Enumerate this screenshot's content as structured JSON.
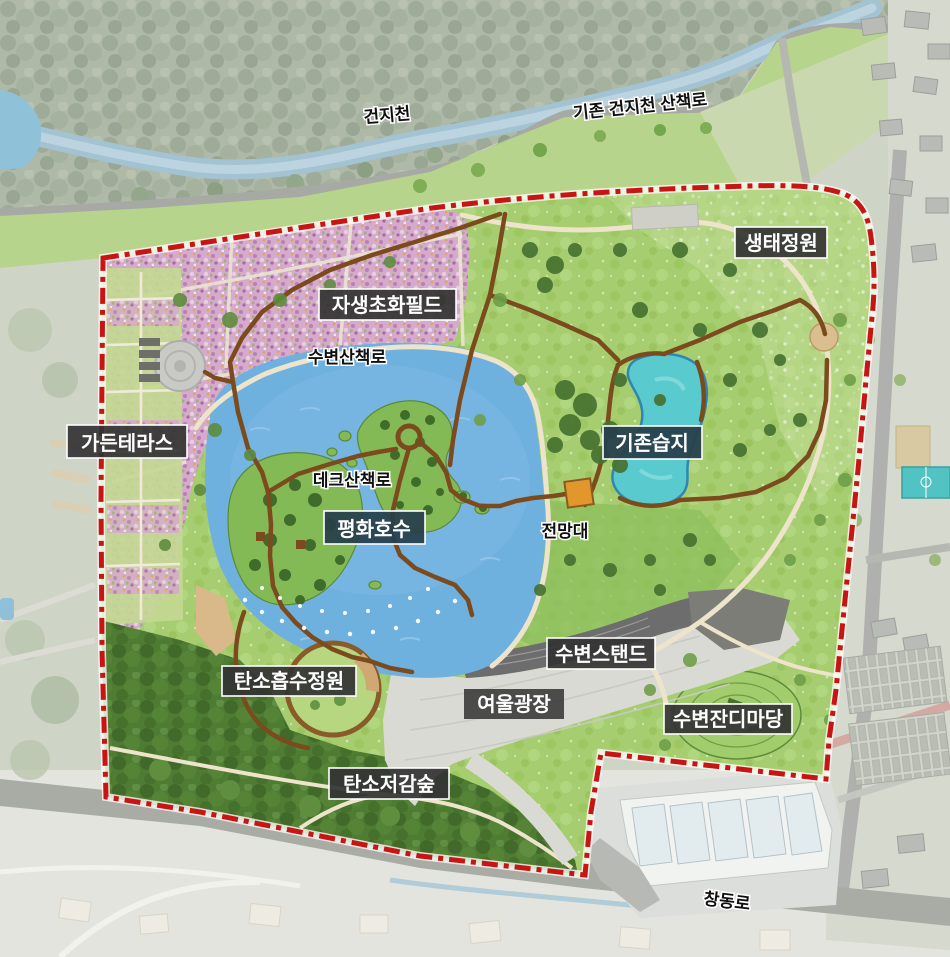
{
  "labels": {
    "regions": {
      "eco_garden": "생태정원",
      "wildflower_field": "자생초화필드",
      "garden_terrace": "가든테라스",
      "existing_wetland": "기존습지",
      "peace_lake": "평화호수",
      "waterside_stand": "수변스탠드",
      "yeoul_plaza": "여울광장",
      "waterside_lawn": "수변잔디마당",
      "carbon_absorption_garden": "탄소흡수정원",
      "carbon_reduction_forest": "탄소저감숲"
    },
    "features": {
      "stream": "건지천",
      "existing_stream_trail": "기존 건지천 산책로",
      "waterside_trail": "수변산책로",
      "deck_trail": "데크산책로",
      "observatory": "전망대",
      "changdong_road": "창동로"
    }
  },
  "colors": {
    "boundary": "#c81414",
    "lake": "#6fb1de",
    "wetland": "#59cace",
    "meadow": "#a6ce70",
    "flower_field": "#d4abca",
    "deck_path": "#7b4a1d",
    "path_cream": "#ede4cb",
    "plaza": "#dadad4",
    "forest": "#4f7c33",
    "label_box": "#333333",
    "label_box_navy": "#27404d"
  }
}
